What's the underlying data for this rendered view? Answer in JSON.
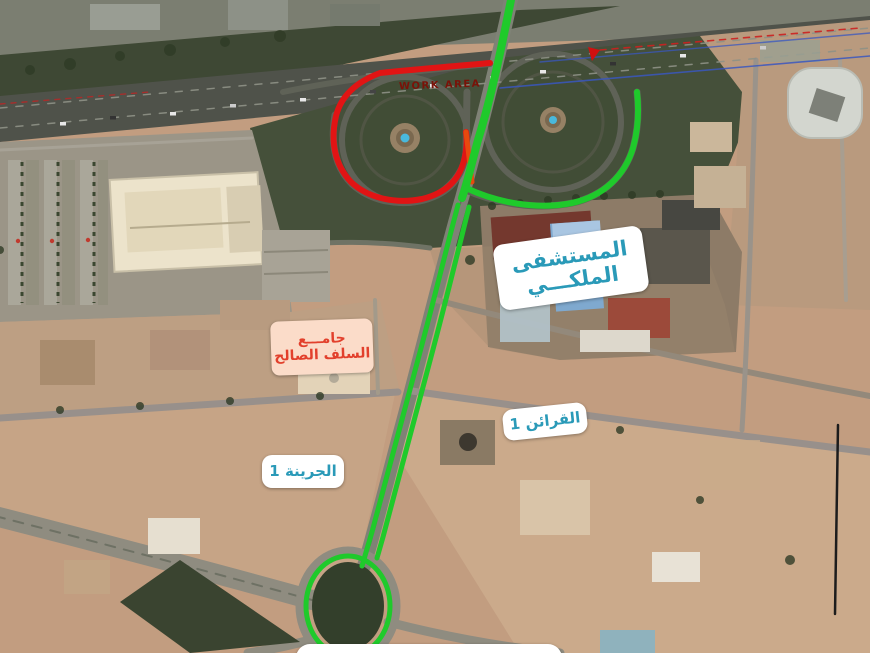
{
  "image": {
    "description": "Aerial satellite photo annotated with road closure (red) and detour route (green)",
    "width_px": 870,
    "height_px": 653
  },
  "annotations": {
    "work_area_label": "WORK AREA",
    "labels": {
      "hospital": {
        "line1": "المستشفى",
        "line2": "الملكـــي"
      },
      "mosque": {
        "line1": "جامـــع",
        "line2": "السلف الصالح"
      },
      "qarain": {
        "text": "القرائن 1"
      },
      "jarina": {
        "text": "الجرينة 1"
      }
    },
    "colors": {
      "route_open_green": "#1fca2b",
      "route_closed_red": "#e11414",
      "label_teal_text": "#2a9ab8",
      "label_red_text": "#e2402c",
      "mosque_label_bg": "#fbdcc9",
      "work_area_text": "#7a1208"
    }
  }
}
